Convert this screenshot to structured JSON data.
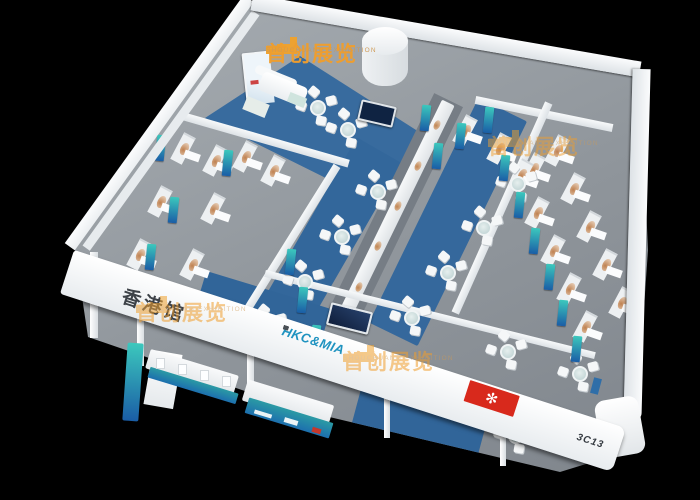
{
  "scene": {
    "background_color": "#000000",
    "description": "isometric 3D render of an exhibition booth design on black background",
    "watermark": {
      "cjk": "首创展览",
      "latin": "SHOUCHUANG EXHIBITION",
      "orange": "#f09e2d",
      "instances": [
        {
          "x": 266,
          "y": 44,
          "opacity": 0.97
        },
        {
          "x": 488,
          "y": 137,
          "opacity": 0.5
        },
        {
          "x": 136,
          "y": 303,
          "opacity": 0.55
        },
        {
          "x": 343,
          "y": 352,
          "opacity": 0.55
        }
      ]
    },
    "fascia": {
      "pavilion_cjk": "香港馆",
      "brand": "HKC&MIA",
      "booth_number": "3C13",
      "flag": "hong-kong-flag",
      "flag_emblem": "✻"
    },
    "colors": {
      "wall_white": "#f2f4f6",
      "floor_gray": "#8f959b",
      "carpet_blue": "#33679b",
      "banner_teal_top": "#3cc8bd",
      "banner_blue_bottom": "#1a5da6",
      "flag_red": "#d8291c",
      "brand_text": "#1f93c0",
      "artwork_tan": "#bf8150"
    },
    "banners": [
      [
        160,
        148
      ],
      [
        173,
        210
      ],
      [
        150,
        257
      ],
      [
        227,
        163
      ],
      [
        290,
        262
      ],
      [
        302,
        300
      ],
      [
        315,
        338
      ],
      [
        488,
        120
      ],
      [
        504,
        168
      ],
      [
        519,
        205
      ],
      [
        534,
        241
      ],
      [
        549,
        277
      ],
      [
        562,
        313
      ],
      [
        576,
        349
      ],
      [
        425,
        118
      ],
      [
        460,
        136
      ],
      [
        437,
        156
      ]
    ],
    "pods": [
      [
        186,
        150
      ],
      [
        218,
        162
      ],
      [
        163,
        203
      ],
      [
        216,
        210
      ],
      [
        142,
        256
      ],
      [
        195,
        266
      ],
      [
        248,
        158
      ],
      [
        276,
        172
      ],
      [
        468,
        132
      ],
      [
        502,
        150
      ],
      [
        536,
        170
      ],
      [
        524,
        176
      ],
      [
        560,
        152
      ],
      [
        540,
        214
      ],
      [
        576,
        190
      ],
      [
        556,
        252
      ],
      [
        592,
        228
      ],
      [
        572,
        290
      ],
      [
        608,
        266
      ],
      [
        588,
        328
      ],
      [
        624,
        304
      ]
    ],
    "tables": [
      [
        268,
        326
      ],
      [
        305,
        282
      ],
      [
        342,
        237
      ],
      [
        378,
        192
      ],
      [
        412,
        318
      ],
      [
        448,
        273
      ],
      [
        484,
        228
      ],
      [
        518,
        184
      ],
      [
        508,
        352
      ],
      [
        580,
        374
      ],
      [
        516,
        436
      ],
      [
        318,
        108
      ],
      [
        348,
        130
      ]
    ],
    "spine_blobs": [
      [
        359,
        287
      ],
      [
        378,
        246
      ],
      [
        398,
        206
      ],
      [
        418,
        166
      ],
      [
        437,
        125
      ]
    ],
    "posts": [
      [
        90,
        252,
        8,
        86
      ],
      [
        137,
        308,
        7,
        58
      ],
      [
        247,
        346,
        7,
        52
      ],
      [
        384,
        392,
        6,
        46
      ],
      [
        500,
        430,
        6,
        36
      ]
    ]
  }
}
